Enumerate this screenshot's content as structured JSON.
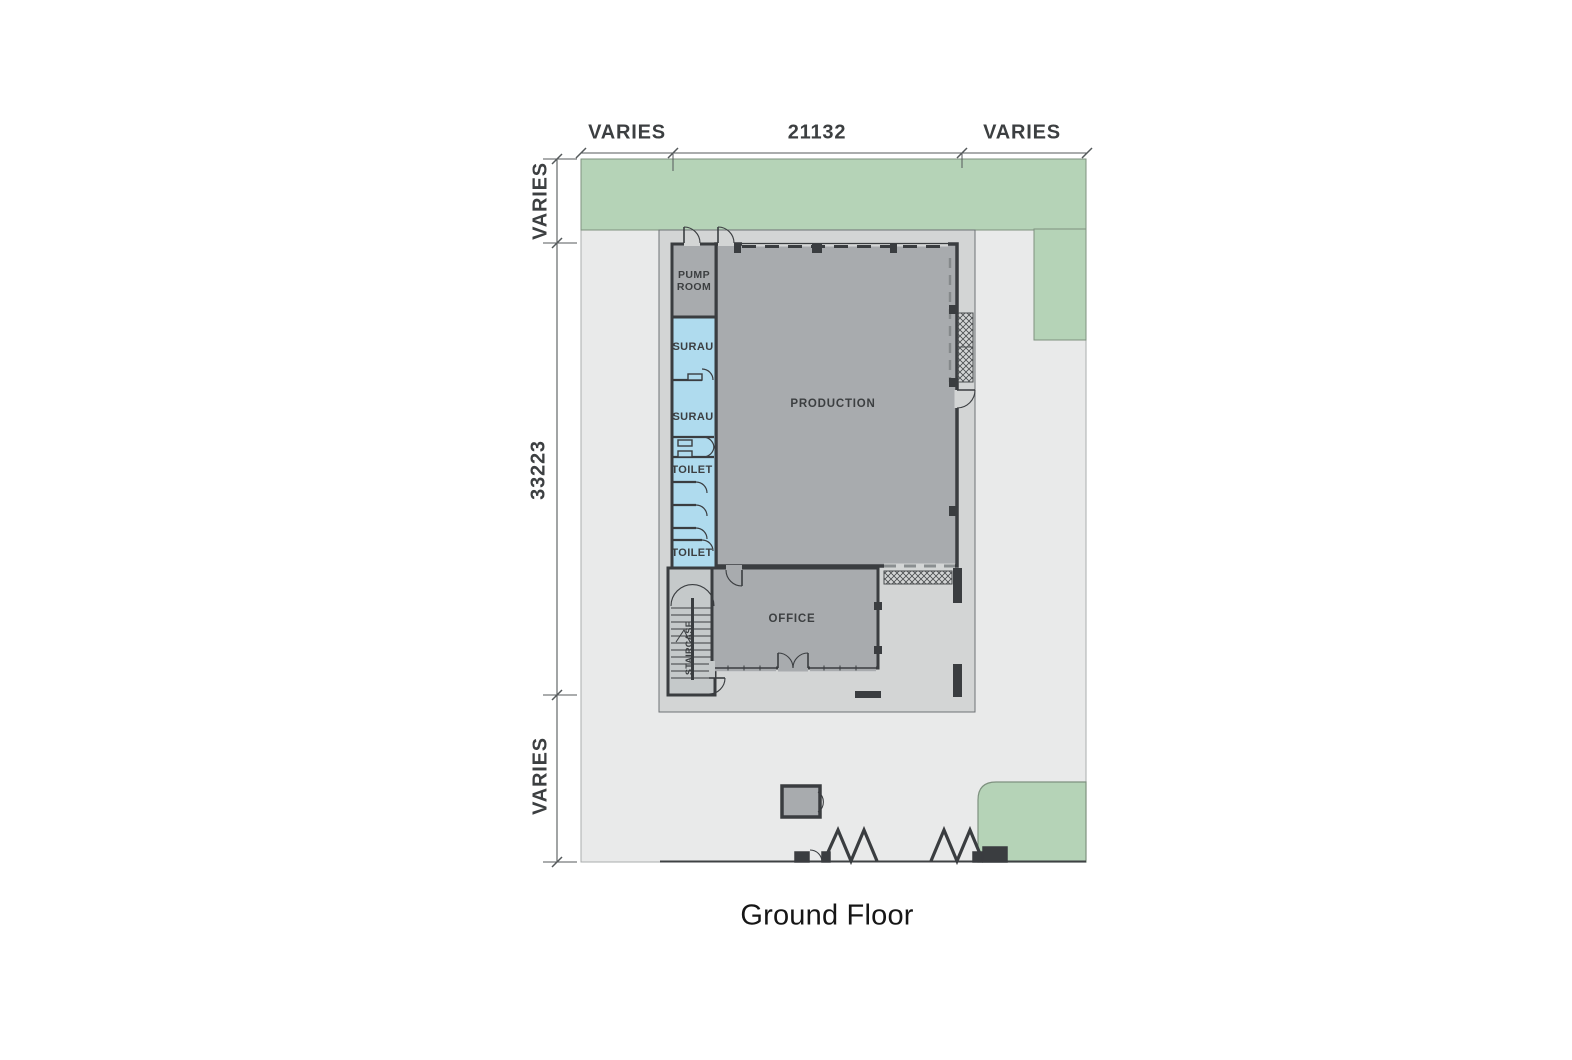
{
  "drawing_title": "Ground Floor",
  "dimensions": {
    "top": {
      "left": "VARIES",
      "center": "21132",
      "right": "VARIES"
    },
    "left": {
      "top": "VARIES",
      "center": "33223",
      "bottom": "VARIES"
    }
  },
  "rooms": {
    "pump_room": "PUMP ROOM",
    "surau_1": "SURAU",
    "surau_2": "SURAU",
    "toilet_1": "TOILET",
    "toilet_2": "TOILET",
    "production": "PRODUCTION",
    "office": "OFFICE",
    "staircase": "STAIRCASE"
  },
  "colors": {
    "green": "#b5d3b7",
    "green_stroke": "#7e917f",
    "site": "#e9eaea",
    "site_stroke": "#aaadad",
    "apron": "#d3d5d5",
    "apron_stroke": "#6e7275",
    "room_gray": "#a8abae",
    "room_blue": "#afdbee",
    "stair_fill": "#c5c9ca",
    "wall": "#3a3d40",
    "label": "#3c3f41"
  }
}
